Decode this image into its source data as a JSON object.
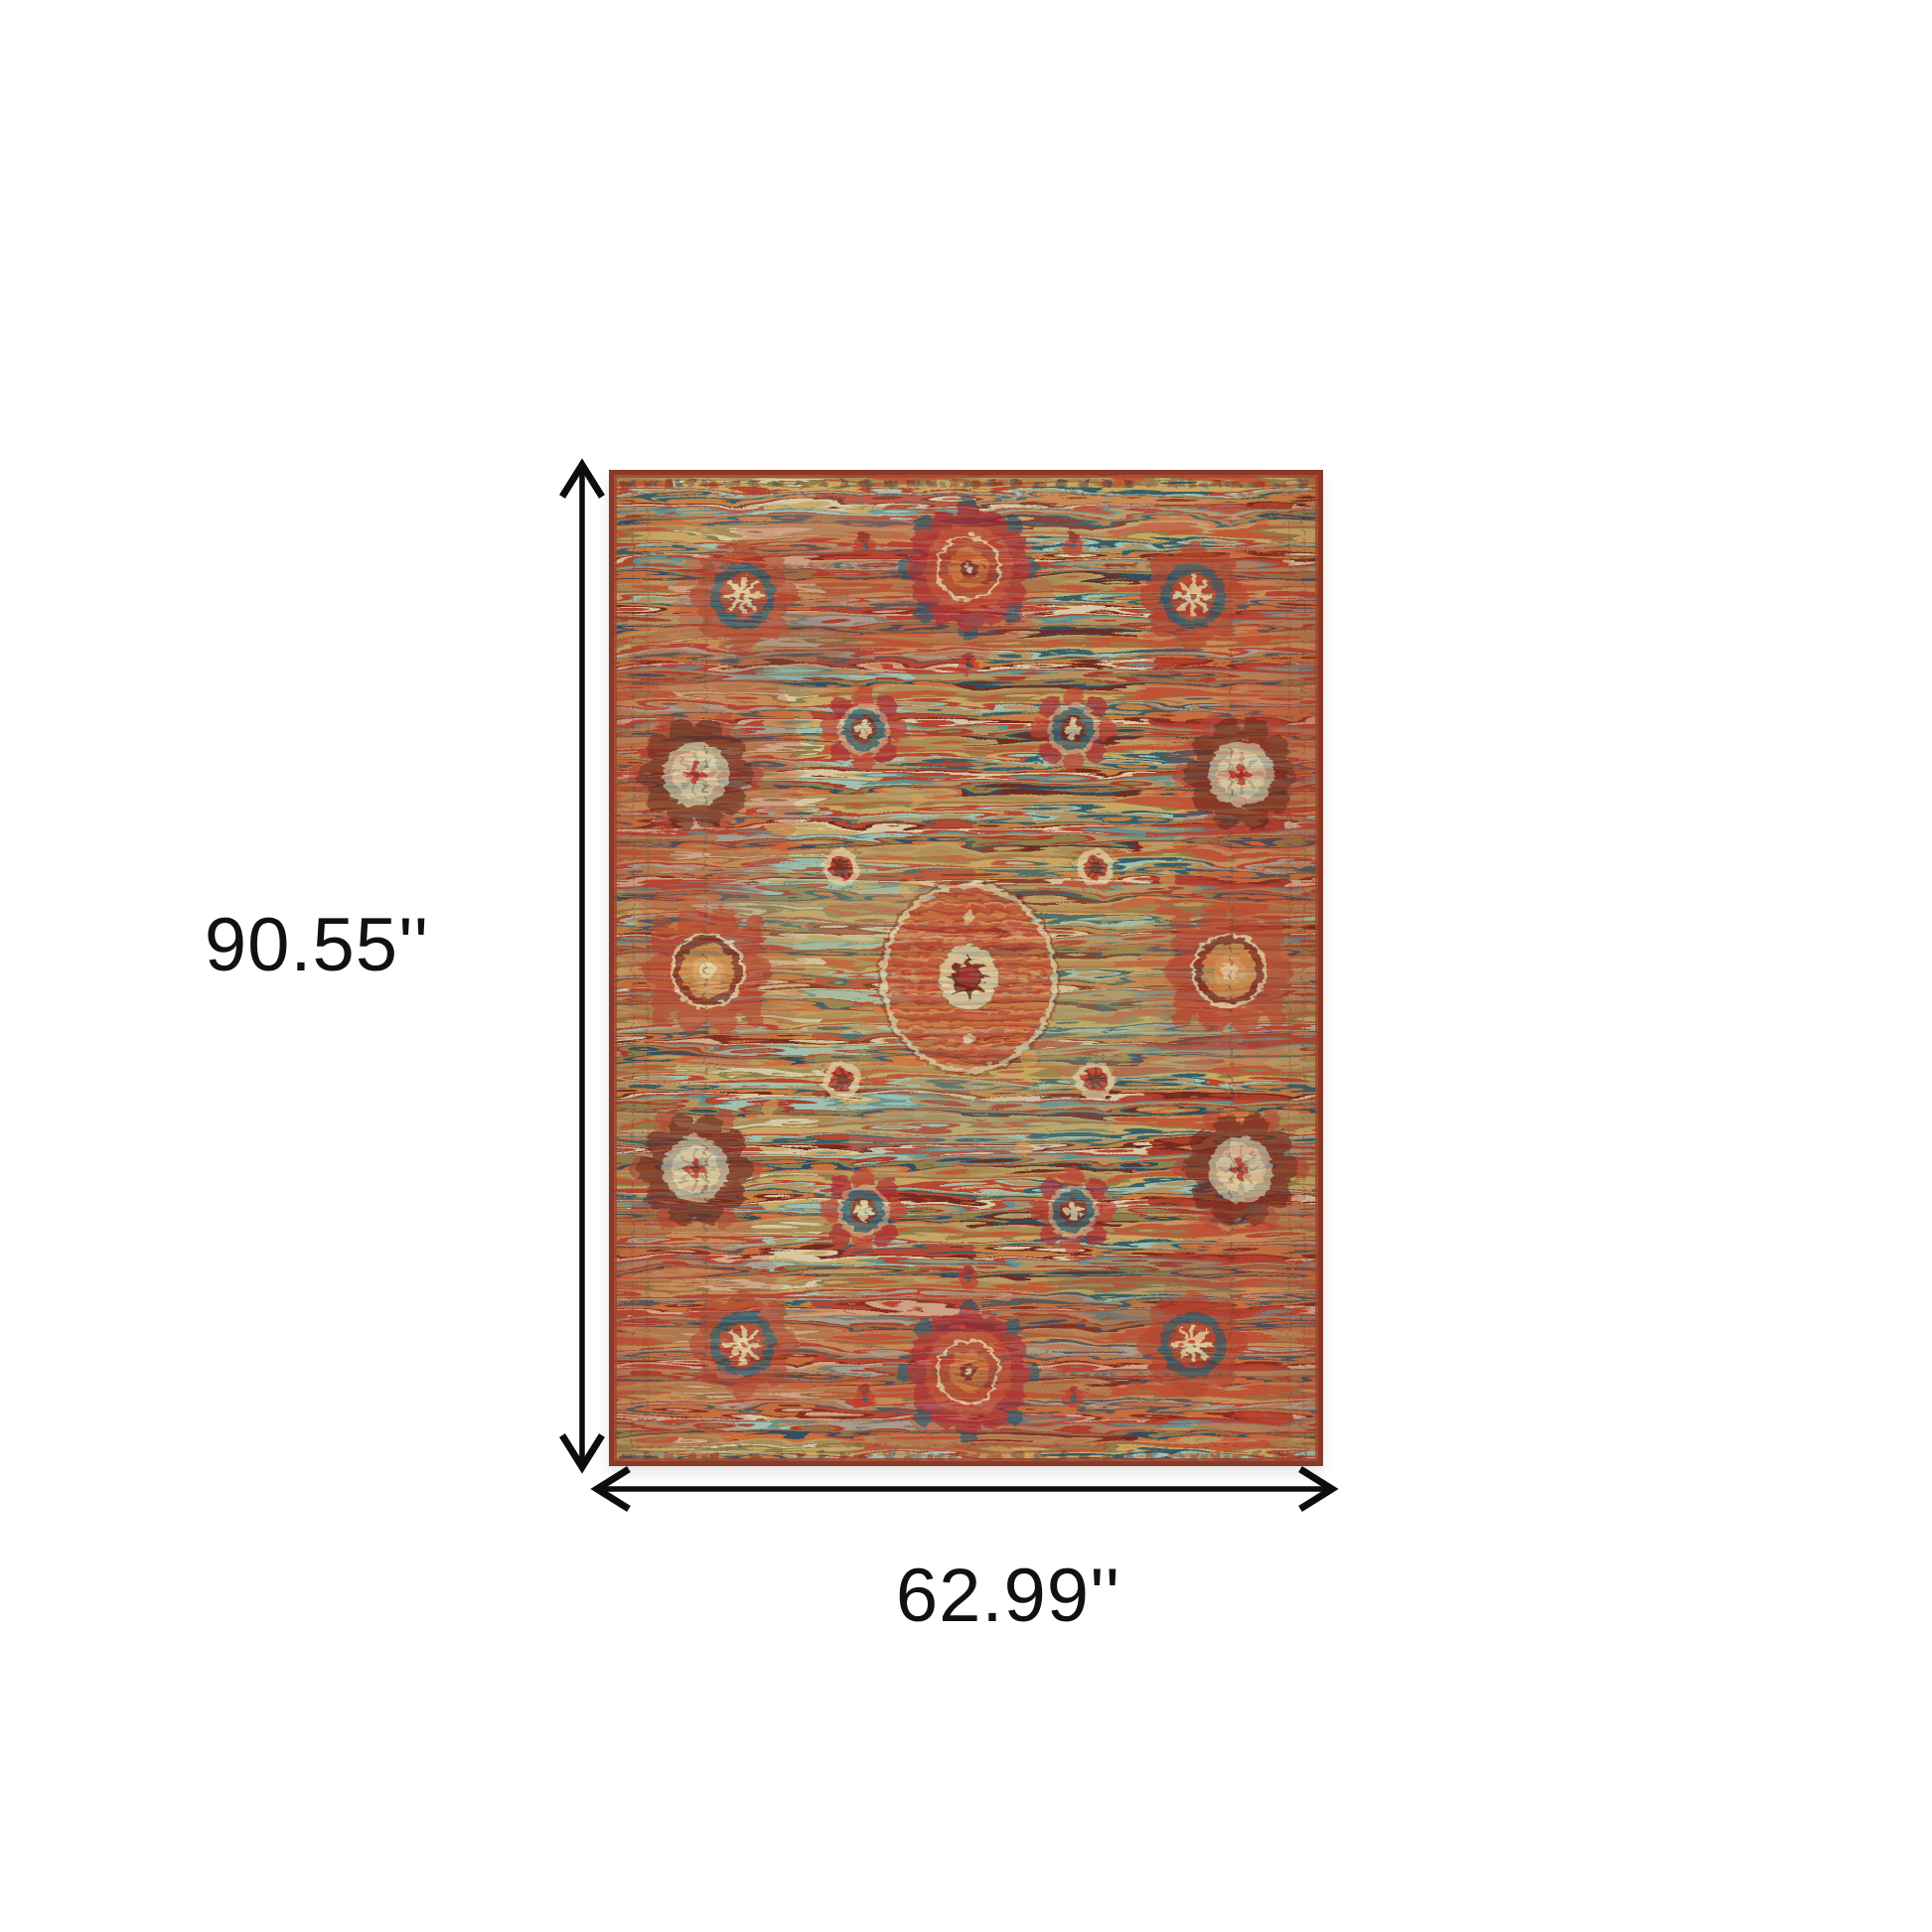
{
  "product_diagram": {
    "type": "rug-dimension-illustration",
    "height_label": "90.55''",
    "width_label": "62.99''"
  },
  "annotation": {
    "arrow_color": "#0d0d0d",
    "label_color": "#111111",
    "background": "#ffffff"
  },
  "rug_palette": {
    "edge_maroon": "#8a3a28",
    "edge_red": "#a0452f",
    "base_tan": "#ab8a52",
    "olive": "#8d7b45",
    "gold": "#c9a55e",
    "red": "#b5402c",
    "bright_red": "#c23327",
    "orange": "#cd6a33",
    "cream": "#e6d7ab",
    "light_teal": "#9fc0ae",
    "mid_teal": "#5d8f8c",
    "dark_teal": "#2f5a64",
    "navy": "#29465d",
    "maroon": "#6e2018",
    "dark_blob": "#5c140f"
  }
}
